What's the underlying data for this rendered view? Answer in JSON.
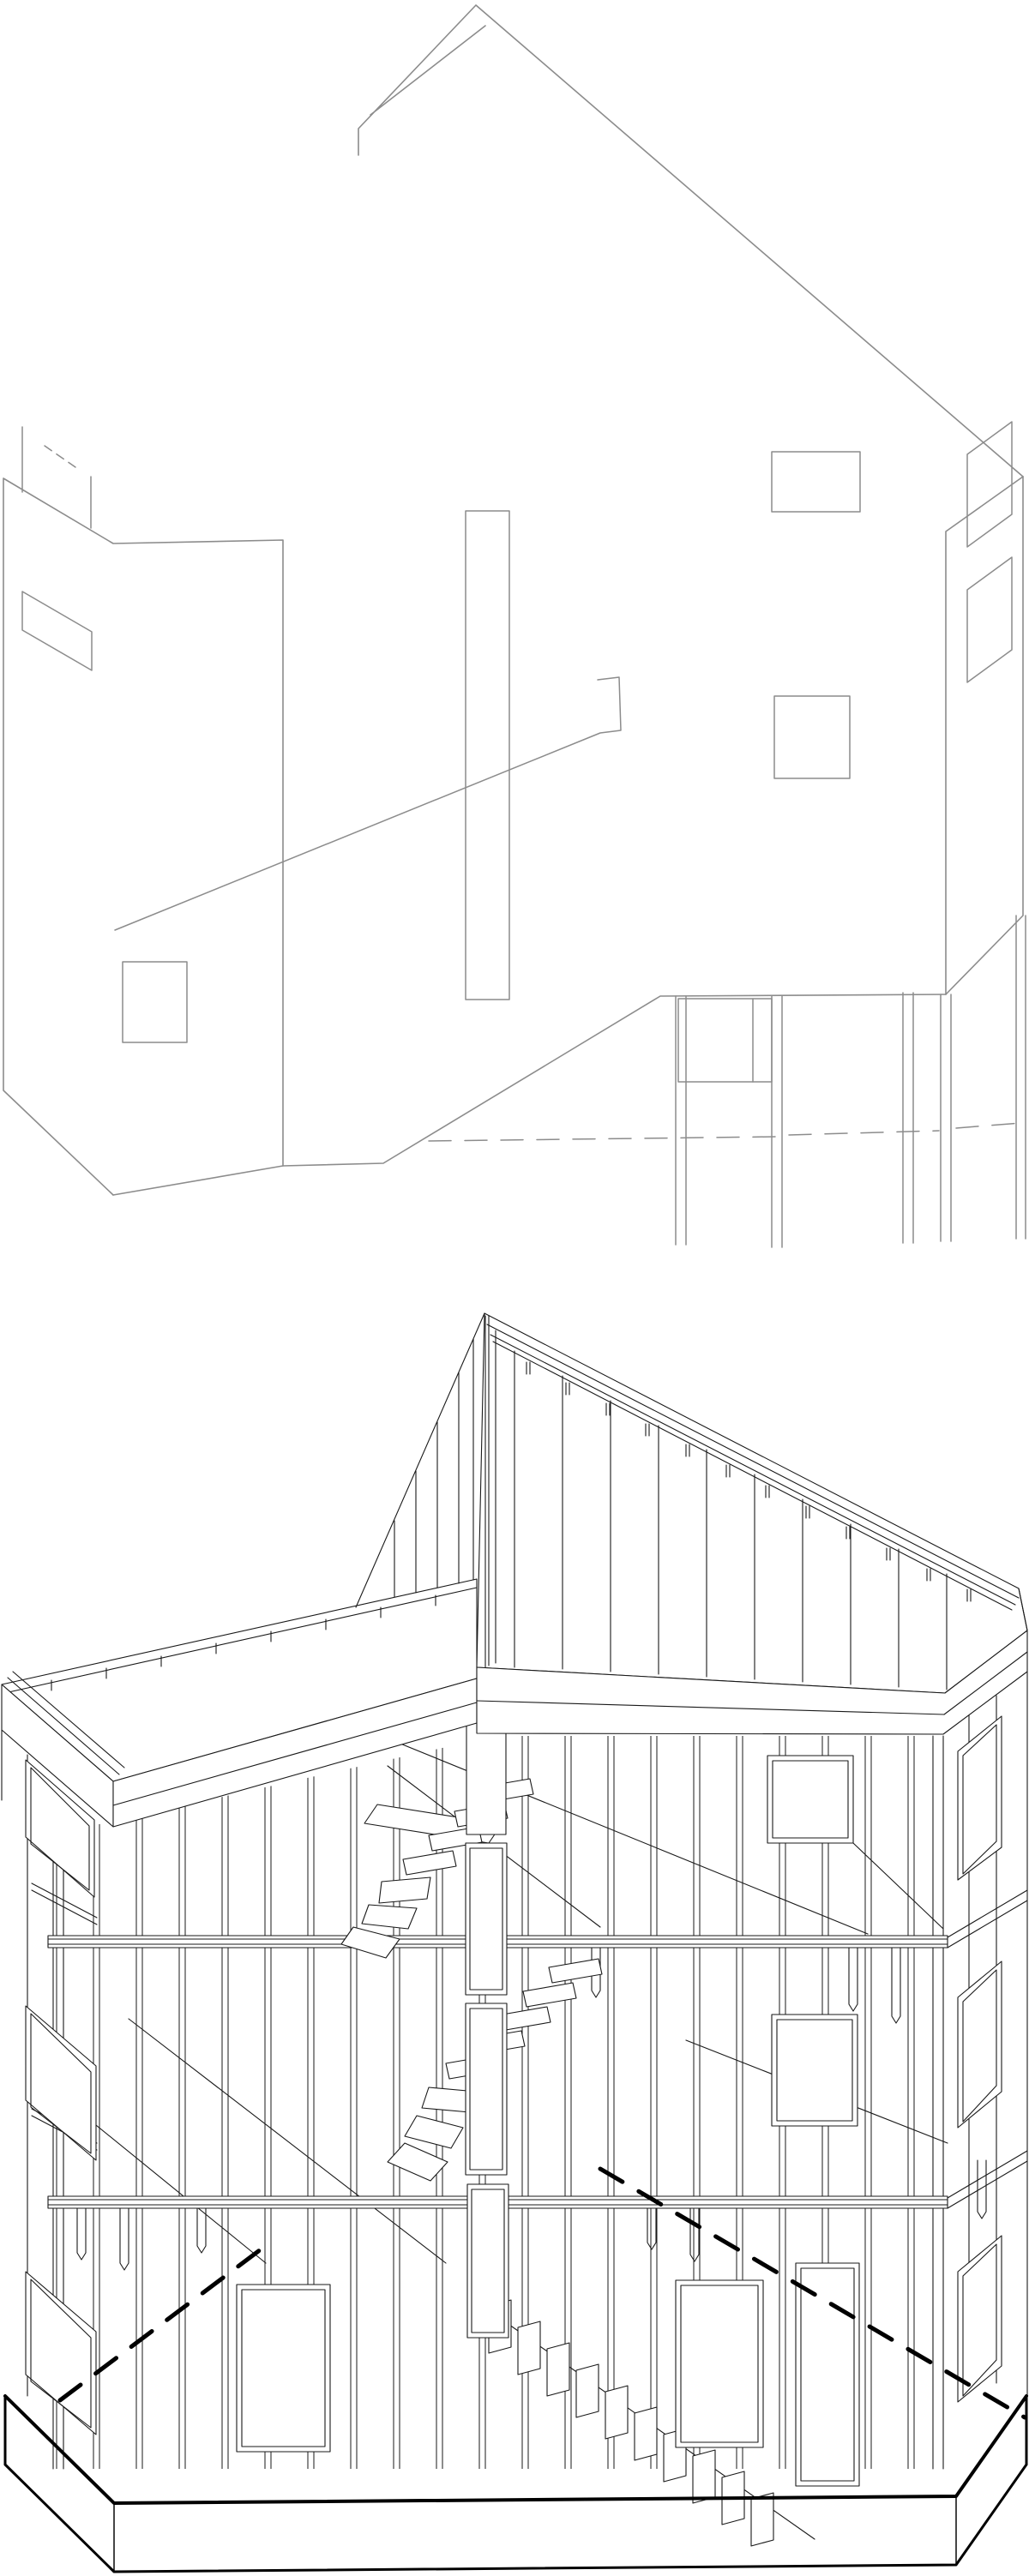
{
  "page": {
    "background_color": "#ffffff",
    "description": "Two stacked axonometric architectural line drawings of the same small gabled building: exterior massing study above, structural timber framing cutaway below"
  },
  "figures": {
    "exterior": {
      "label": "exterior-massing-axonometric",
      "description": "Light gray outline axonometric of building exterior with gable roof, strip window, rectangular windows, pilotis columns and dashed ground line",
      "stroke": "#8c8c8c",
      "fill": "none"
    },
    "frame": {
      "label": "structural-framing-axonometric",
      "description": "Black wireframe axonometric cutaway showing stud walls, floor beams, gable rafter plates with tick marks, winder staircase, window frames and hexagonal base plinth",
      "stroke": "#1a1a1a",
      "heavy_stroke": "#000000",
      "fill": "#ffffff"
    }
  }
}
